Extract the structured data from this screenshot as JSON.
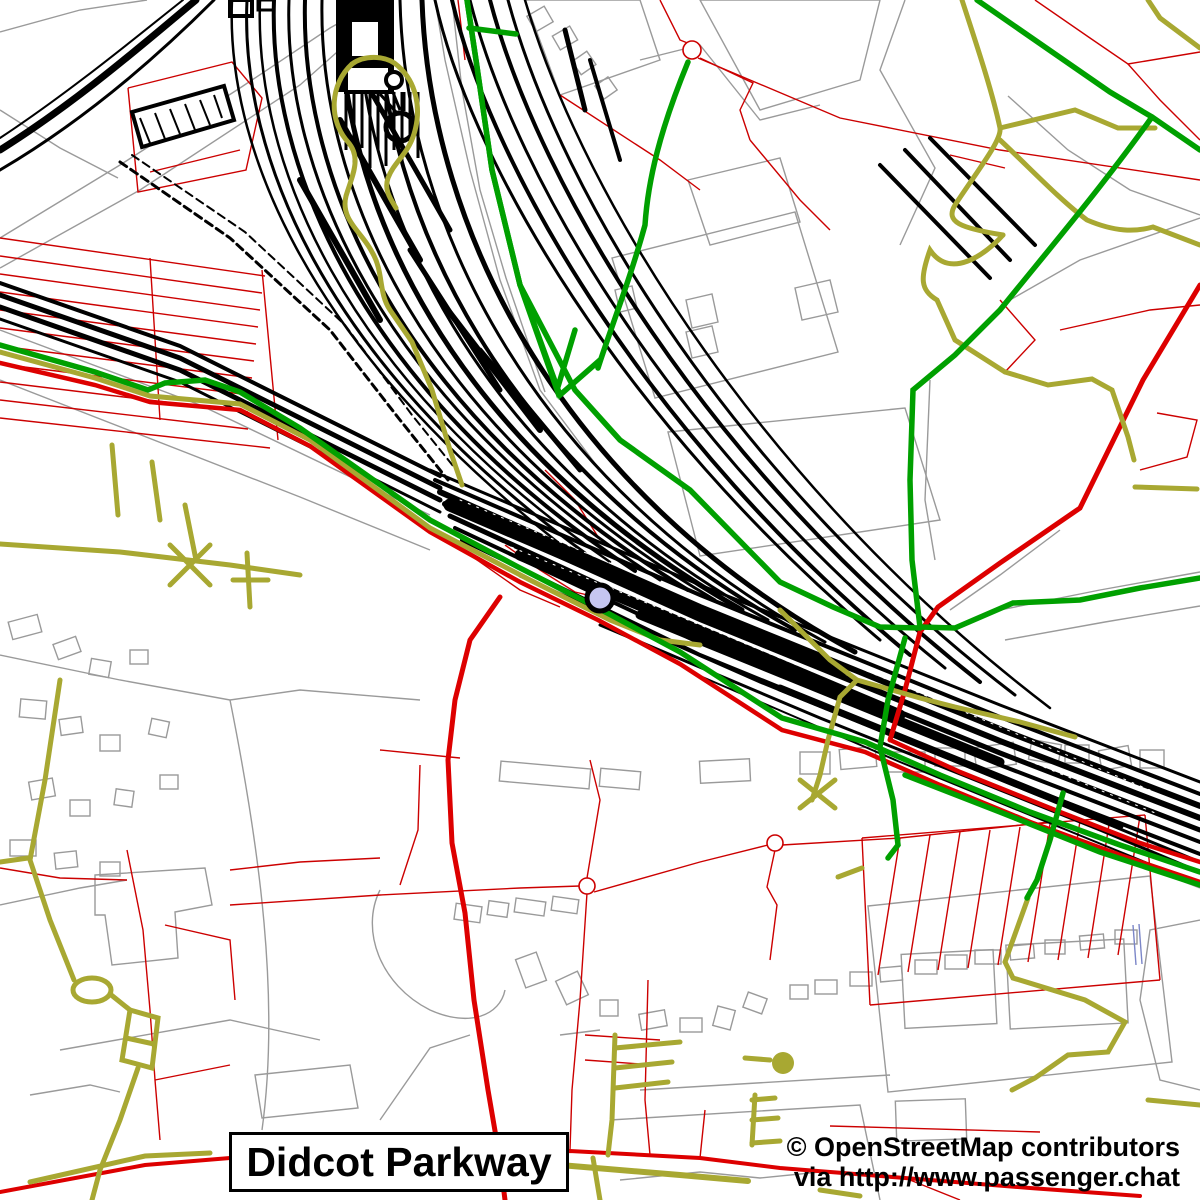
{
  "map": {
    "title": "Didcot Parkway",
    "attribution": {
      "line1": "© OpenStreetMap contributors",
      "line2": "via http://www.passenger.chat"
    },
    "marker": {
      "label": "Didcot Parkway station",
      "fill": "#c6c6f0",
      "stroke": "#000000"
    },
    "colors": {
      "railway": "#000000",
      "green_road": "#00a000",
      "major_red_road": "#dd0000",
      "minor_red_road": "#cc0000",
      "track_road": "#a8a832",
      "building_outline": "#999999",
      "water": "#7b86c8",
      "background": "#ffffff"
    }
  }
}
